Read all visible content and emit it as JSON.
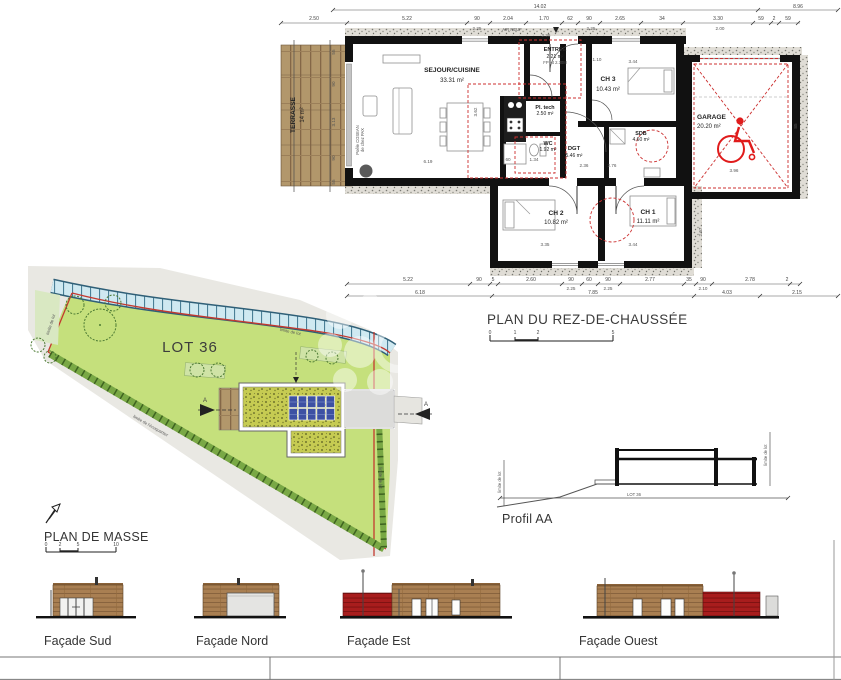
{
  "floor_plan": {
    "title": "PLAN DU REZ-DE-CHAUSSÉE",
    "scale_labels": [
      "0",
      "1",
      "2",
      "5"
    ],
    "rooms": {
      "sejour": {
        "name": "SEJOUR/CUISINE",
        "area": "33.31 m²"
      },
      "entree": {
        "name": "ENTREE",
        "area": "2.21 m²",
        "note": "FP Ht 2.30M"
      },
      "ch3": {
        "name": "CH 3",
        "area": "10.43 m²"
      },
      "garage": {
        "name": "GARAGE",
        "area": "20.20 m²"
      },
      "pl_tech": {
        "name": "Pl. tech",
        "area": "2.50 m²"
      },
      "wc": {
        "name": "WC",
        "area": "1.92 m²"
      },
      "dgt": {
        "name": "DGT",
        "area": "5.46 m²"
      },
      "sdb": {
        "name": "SDB",
        "area": "4.60 m²"
      },
      "ch2": {
        "name": "CH 2",
        "area": "10.82 m²"
      },
      "ch1": {
        "name": "CH 1",
        "area": "11.11 m²"
      },
      "terrasse": {
        "name": "TERRASSE",
        "area": "14 m²"
      }
    },
    "annotations": {
      "air_neuf": "AIR NEUF",
      "poele_line1": "Poêle COSEAN",
      "poele_line2": "de chez PAX"
    },
    "dims": {
      "overall_left": "14.02",
      "overall_right": "8.96",
      "top": [
        "2.50",
        "5.22",
        "90",
        "2.04",
        "1.70",
        "62",
        "90",
        "2.65",
        "34",
        "3.30",
        "59",
        "2",
        "59"
      ],
      "top_sub": [
        "2.25",
        "2.25",
        "2.25",
        "2.00"
      ],
      "bottom": [
        "5.22",
        "90",
        "5",
        "2.60",
        "90",
        "60",
        "90",
        "2.77",
        "35",
        "90",
        "2.78",
        "2"
      ],
      "bottom_sub": [
        "2.25",
        "2.25",
        "2.10"
      ],
      "bottom_total": [
        "6.18",
        "7.85",
        "4.03",
        "2.15"
      ],
      "inner": [
        "3.44",
        "1.10",
        "6.19",
        "3.62",
        "3.35",
        "3.44",
        "2.36",
        "2.76",
        "1.34",
        "60",
        "3.96",
        "2.67",
        "85",
        "55",
        "90",
        "3.13",
        "90",
        "55"
      ]
    }
  },
  "site_plan": {
    "title": "PLAN DE MASSE",
    "lot_label": "LOT 36",
    "section_marker": "A",
    "limit_lot": "limite de lot",
    "limit_ecoquartier": "limite de l'écoquartier",
    "scale_labels": [
      "0",
      "2",
      "5",
      "10"
    ]
  },
  "profile": {
    "title": "Profil AA",
    "lot_dim": "LOT 36",
    "limit_label": "limite de lot"
  },
  "facades": {
    "sud": {
      "label": "Façade Sud"
    },
    "nord": {
      "label": "Façade Nord"
    },
    "est": {
      "label": "Façade Est"
    },
    "ouest": {
      "label": "Façade Ouest"
    }
  },
  "colors": {
    "wall": "#111111",
    "red_overlay": "#cc2f2f",
    "accessibility_red": "#e01b1b",
    "lot_green": "#c5e07c",
    "path_blue": "#cfe9f1",
    "wood": "#b2976b",
    "facade_brown": "#a97f52",
    "facade_red": "#a81d1d",
    "roof_veg": "#c6cb52",
    "solar_blue": "#3d51a3"
  }
}
